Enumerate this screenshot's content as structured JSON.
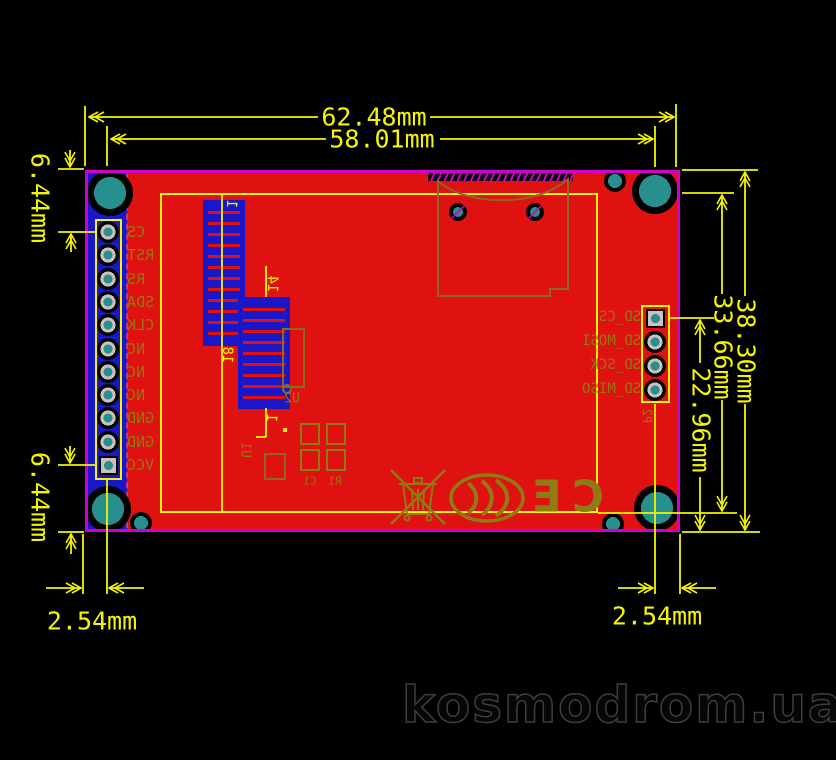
{
  "dimensions": {
    "top": [
      "62.48mm",
      "58.01mm"
    ],
    "right": [
      "38.30mm",
      "33.66mm",
      "22.96mm"
    ],
    "left_side": [
      "6.44mm",
      "6.44mm"
    ],
    "bottom": [
      "2.54mm",
      "2.54mm"
    ]
  },
  "board": {
    "left_header": {
      "pins": [
        "CS",
        "RST",
        "RS",
        "SDA",
        "CLK",
        "NC",
        "NC",
        "NC",
        "GND",
        "GND",
        "VCC"
      ]
    },
    "sd_header": {
      "designator": "P2",
      "pins": [
        "SD_CS",
        "SD_MOSI",
        "SD_SCK",
        "SD_MISO"
      ]
    },
    "fpc_connectors": [
      {
        "first_pin": "1",
        "last_pin": "18"
      },
      {
        "first_pin": "14",
        "last_pin": "1"
      }
    ],
    "components": {
      "u1": "U1",
      "u2": "U2",
      "c1": "C1",
      "r1": "R1"
    },
    "marks": {
      "ce": "CE"
    }
  },
  "watermark": {
    "text": "kosmodrom.ua"
  },
  "colors": {
    "board_red": "#e01111",
    "outline_magenta": "#cf00cf",
    "dimension_yellow": "#f5f500",
    "silk_olive": "#8f7a14",
    "connector_blue": "#1a17c9",
    "hole_teal": "#27908f",
    "background": "#000000"
  }
}
